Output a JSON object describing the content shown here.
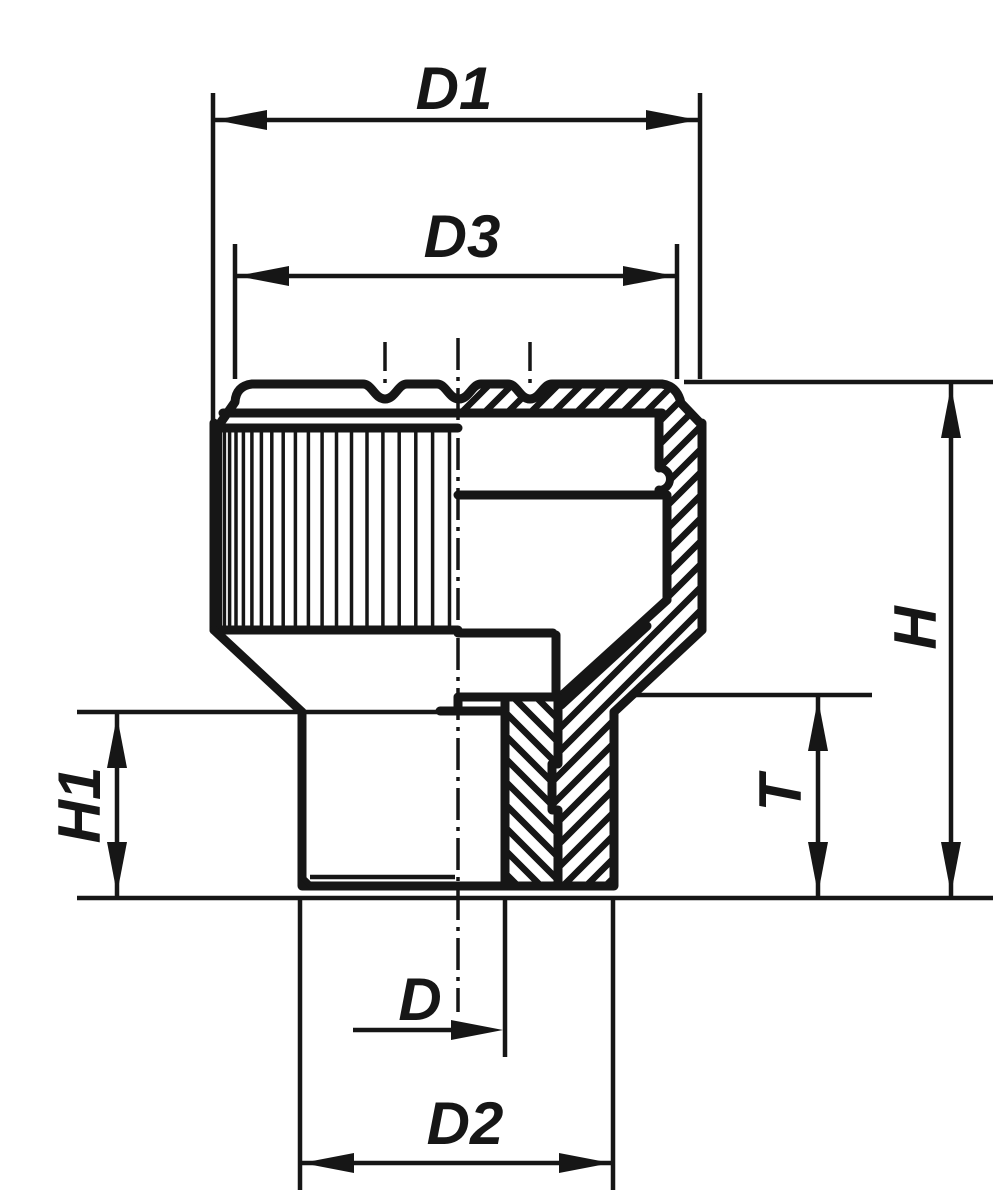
{
  "drawing": {
    "background_color": "#ffffff",
    "ink_color": "#161616",
    "dimension_labels": {
      "d1": "D1",
      "d3": "D3",
      "h": "H",
      "h1": "H1",
      "t": "T",
      "d": "D",
      "d2": "D2"
    }
  }
}
